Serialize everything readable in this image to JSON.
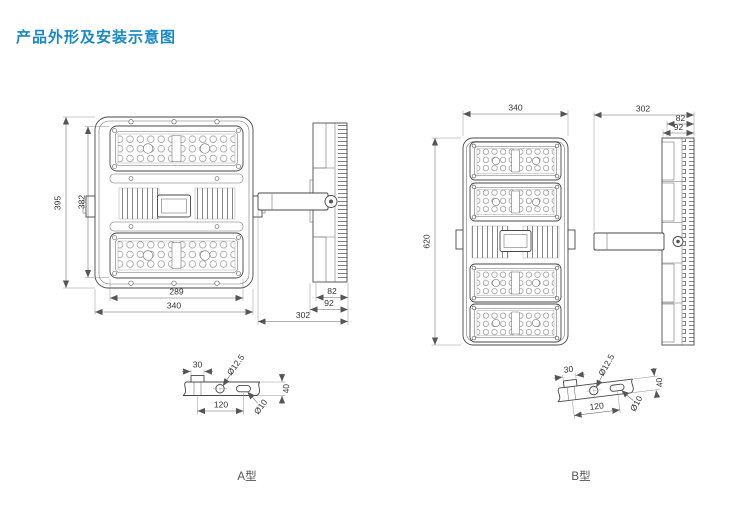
{
  "page": {
    "title": "产品外形及安装示意图",
    "title_color": "#1789c8"
  },
  "typeA": {
    "label": "A型",
    "front_view": {
      "height_outer": "395",
      "height_inner": "382",
      "width_inner": "289",
      "width_outer": "340"
    },
    "side_view": {
      "depth_module": "82",
      "depth_body": "92",
      "width_total": "302"
    },
    "bracket_detail": {
      "tab_width": "30",
      "hole_diameter": "Ø12.5",
      "slot_diameter": "Ø10",
      "hole_spacing": "120",
      "plate_width": "40"
    }
  },
  "typeB": {
    "label": "B型",
    "front_view": {
      "width": "340",
      "height": "620"
    },
    "side_view": {
      "depth_module": "82",
      "depth_body": "92",
      "width_total": "302"
    },
    "bracket_detail": {
      "tab_width": "30",
      "hole_diameter": "Ø12.5",
      "slot_diameter": "Ø10",
      "hole_spacing": "120",
      "plate_width": "40"
    }
  }
}
